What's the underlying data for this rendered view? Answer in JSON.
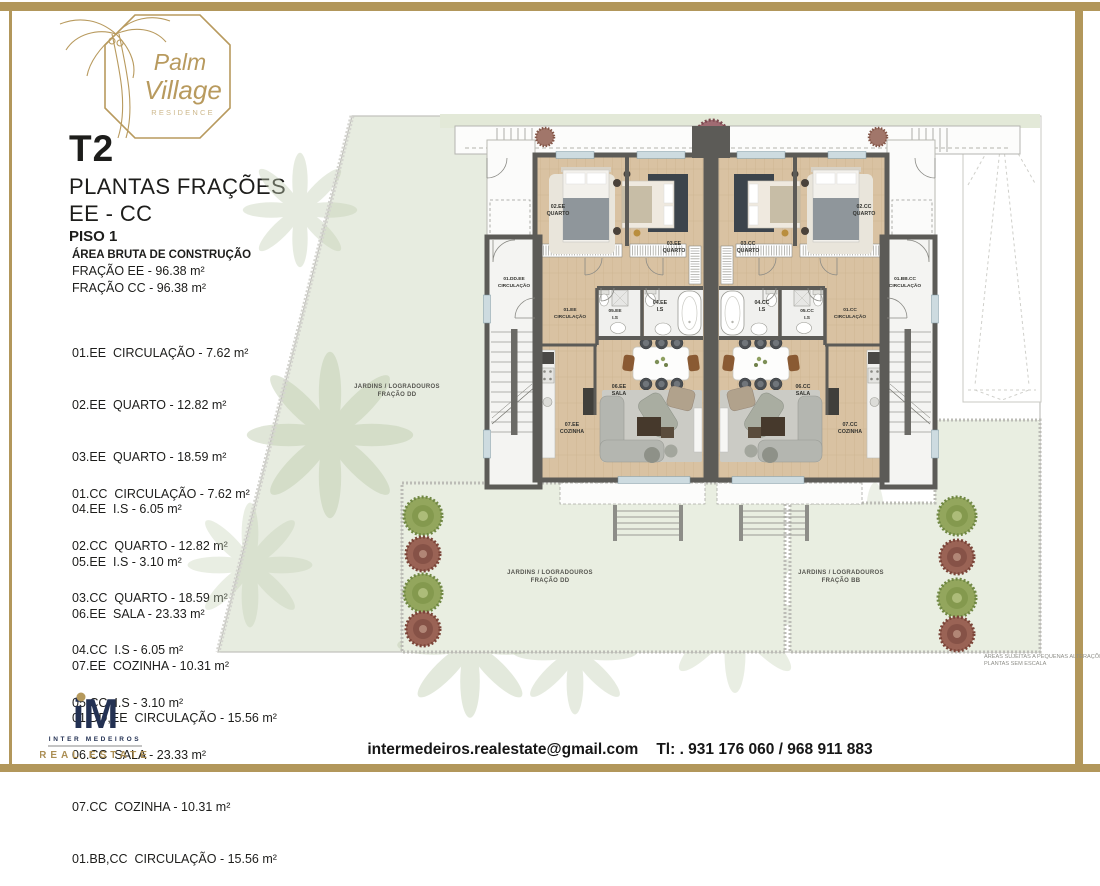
{
  "logo": {
    "brand_line1": "Palm",
    "brand_line2": "Village",
    "brand_sub": "RESIDENCE",
    "gold": "#b89a5e"
  },
  "title_block": {
    "type": "T2",
    "subtitle": "PLANTAS FRAÇÕES",
    "fractions": "EE - CC",
    "floor": "PISO 1",
    "area_heading": "ÁREA BRUTA DE CONSTRUÇÃO",
    "area_ee": "FRAÇÃO EE - 96.38 m²",
    "area_cc": "FRAÇÃO CC - 96.38 m²"
  },
  "lists": {
    "ee": [
      "01.EE  CIRCULAÇÃO - 7.62 m²",
      "02.EE  QUARTO - 12.82 m²",
      "03.EE  QUARTO - 18.59 m²",
      "04.EE  I.S - 6.05 m²",
      "05.EE  I.S - 3.10 m²",
      "06.EE  SALA - 23.33 m²",
      "07.EE  COZINHA - 10.31 m²",
      "01.DD,EE  CIRCULAÇÃO - 15.56 m²"
    ],
    "cc": [
      "01.CC  CIRCULAÇÃO - 7.62 m²",
      "02.CC  QUARTO - 12.82 m²",
      "03.CC  QUARTO - 18.59 m²",
      "04.CC  I.S - 6.05 m²",
      "05.CC  I.S - 3.10 m²",
      "06.CC  SALA - 23.33 m²",
      "07.CC  COZINHA - 10.31 m²",
      "01.BB,CC  CIRCULAÇÃO - 15.56 m²"
    ]
  },
  "plan": {
    "rooms": {
      "ee": {
        "q02": [
          "02.EE",
          "QUARTO"
        ],
        "q03": [
          "03.EE",
          "QUARTO"
        ],
        "circ_dd": [
          "01.DD.EE",
          "CIRCULAÇÃO"
        ],
        "circ": [
          "01.EE",
          "CIRCULAÇÃO"
        ],
        "is05": [
          "05.EE",
          "I.S"
        ],
        "is04": [
          "04.EE",
          "I.S"
        ],
        "sala": [
          "06.EE",
          "SALA"
        ],
        "cozinha": [
          "07.EE",
          "COZINHA"
        ]
      },
      "cc": {
        "q02": [
          "02.CC",
          "QUARTO"
        ],
        "q03": [
          "03.CC",
          "QUARTO"
        ],
        "circ_bb": [
          "01.BB.CC",
          "CIRCULAÇÃO"
        ],
        "circ": [
          "01.CC",
          "CIRCULAÇÃO"
        ],
        "is05": [
          "05.CC",
          "I.S"
        ],
        "is04": [
          "04.CC",
          "I.S"
        ],
        "sala": [
          "06.CC",
          "SALA"
        ],
        "cozinha": [
          "07.CC",
          "COZINHA"
        ]
      }
    },
    "gardens": {
      "left": [
        "JARDINS  / LOGRADOUROS",
        "FRAÇÃO DD"
      ],
      "bottom_left": [
        "JARDINS  / LOGRADOUROS",
        "FRAÇÃO DD"
      ],
      "bottom_right": [
        "JARDINS  / LOGRADOUROS",
        "FRAÇÃO BB"
      ]
    },
    "note": [
      "ÁREAS SUJEITAS A PEQUENAS ALTERAÇÕES",
      "PLANTAS SEM ESCALA"
    ]
  },
  "footer": {
    "brand_mark": "iM",
    "brand_name": "INTER MEDEIROS",
    "brand_sub": "REAL ESTATE",
    "email": "intermedeiros.realestate@gmail.com",
    "phone": "Tl: . 931 176 060 / 968 911 883",
    "navy": "#233153"
  }
}
